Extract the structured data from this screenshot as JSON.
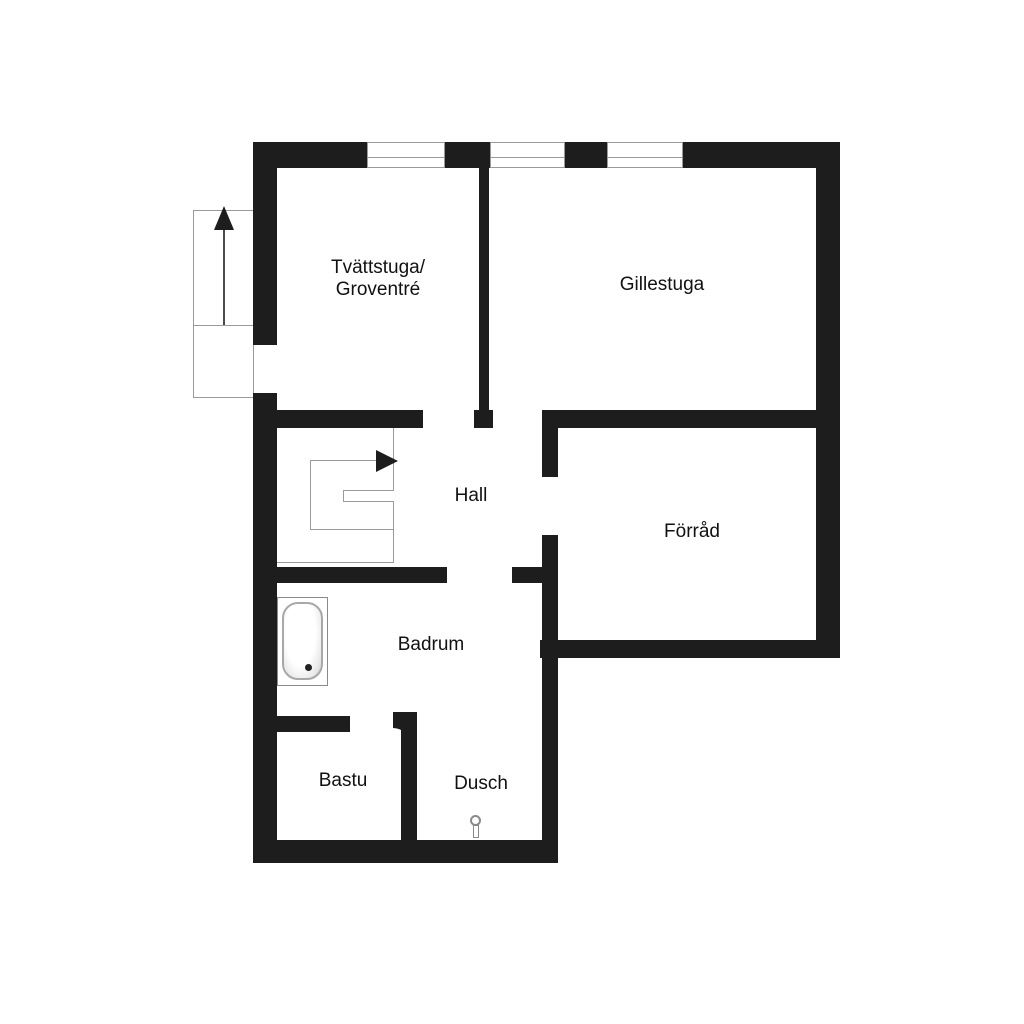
{
  "plan": {
    "title": "Basement floor plan",
    "background": "#ffffff",
    "wall_color": "#1d1d1d",
    "line_color": "#9a9a9a",
    "text_color": "#111111",
    "window_count": 3
  },
  "rooms": {
    "tvattstuga": {
      "label_line1": "Tvättstuga/",
      "label_line2": "Groventré"
    },
    "gillestuga": {
      "label": "Gillestuga"
    },
    "hall": {
      "label": "Hall"
    },
    "forrad": {
      "label": "Förråd"
    },
    "badrum": {
      "label": "Badrum"
    },
    "bastu": {
      "label": "Bastu"
    },
    "dusch": {
      "label": "Dusch"
    }
  },
  "fixtures": {
    "bathtub": "bathtub",
    "shower_mixer": "shower-mixer",
    "entry_stairs": "exterior-stairs-up-arrow",
    "staircase": "interior-stairs-right-arrow"
  }
}
